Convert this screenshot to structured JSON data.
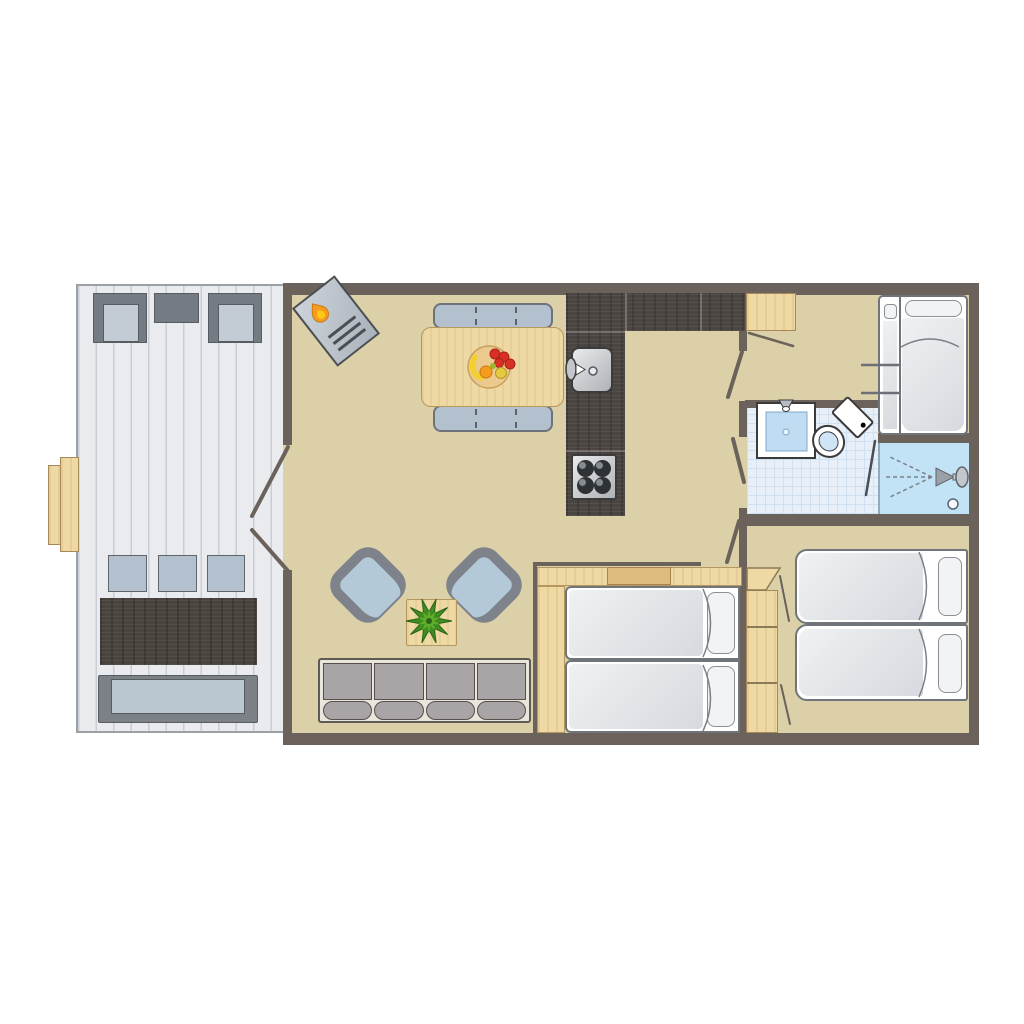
{
  "palette": {
    "wall": "#6b635b",
    "floor": "#dcd0a8",
    "terrace_floor": "#e9ebee",
    "terrace_line": "#c9ced6",
    "terrace_border": "#9aa0a4",
    "gray_dark": "#757b82",
    "seat_light": "#c3ccd4",
    "chair_blue": "#b2c1cd",
    "wood_dark": "#4a443f",
    "wood_light": "#eed9a4",
    "wood_mid": "#ddba7e",
    "bench_seat": "#bac7d0",
    "counter": "#4b4541",
    "steel_light": "#e8eaec",
    "steel_dark": "#aeb2b6",
    "burner": "#2f3235",
    "armchair_arm": "#7d828b",
    "armchair_seat": "#b4c9d8",
    "sofa_frame": "#e9e6dc",
    "sofa_cushion": "#a9a4a6",
    "outline": "#55504b",
    "bath_floor": "#e7f0f9",
    "bath_grid": "#cfe0f0",
    "shower": "#c2e2f6",
    "sink_blue": "#bfdcf2",
    "fixture_line": "#3b3b3b",
    "mattress_hi": "#eff1f3",
    "mattress_lo": "#d6dade",
    "pillow": "#f2f3f5",
    "bed_line": "#70757b",
    "flame_orange": "#f59b1e",
    "flame_yellow": "#fcc918",
    "plant_dark": "#3f8c1f",
    "plant_light": "#5fae2e",
    "fruit_red": "#d93025",
    "fruit_orange": "#f59b1e",
    "fruit_yellow": "#f2d12e",
    "bowl": "#ecc98e"
  },
  "plan": {
    "type": "holiday-home-floor-plan",
    "rooms": [
      {
        "name": "terrace",
        "items": [
          "deck-chair",
          "side-table",
          "deck-chair",
          "entry-steps",
          "garden-chair",
          "garden-chair",
          "garden-chair",
          "dark-wood-table",
          "garden-bench"
        ]
      },
      {
        "name": "living-dining-room",
        "items": [
          "wood-stove",
          "dining-bench",
          "dining-table",
          "fruit-bowl",
          "dining-bench",
          "armchair",
          "armchair",
          "plant-table",
          "plant",
          "sofa",
          "double-terrace-doors"
        ]
      },
      {
        "name": "kitchen",
        "items": [
          "l-shaped-counter",
          "sink",
          "faucet",
          "four-burner-stove"
        ]
      },
      {
        "name": "entry-bedroom",
        "items": [
          "wardrobe",
          "wardrobe-door",
          "bunk-bed",
          "ladder",
          "pillow",
          "pillow"
        ]
      },
      {
        "name": "bathroom",
        "items": [
          "washbasin",
          "tap",
          "toilet",
          "shower-screen",
          "shower",
          "shower-head",
          "spray",
          "drain"
        ]
      },
      {
        "name": "middle-bedroom",
        "items": [
          "headboard-shelf",
          "shelf-box",
          "bed",
          "bed",
          "pillow",
          "pillow",
          "door"
        ]
      },
      {
        "name": "right-bedroom",
        "items": [
          "wardrobe",
          "wardrobe-doors",
          "bed",
          "bed",
          "pillow",
          "pillow",
          "door"
        ]
      }
    ]
  }
}
